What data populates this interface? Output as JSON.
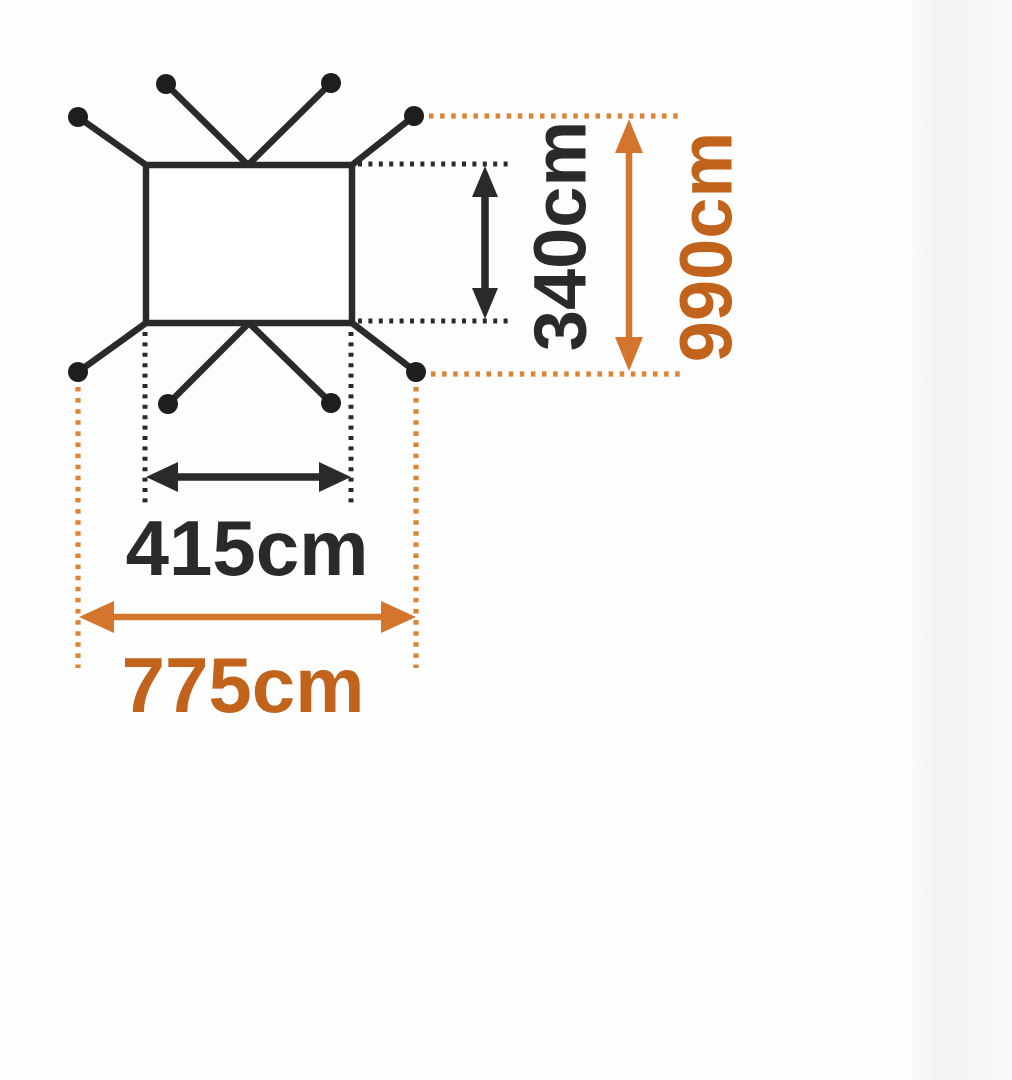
{
  "page": {
    "background_color": "#fdfdfd",
    "right_strip_color": "#f5f5f6"
  },
  "diagram": {
    "colors": {
      "page-bg": "#fdfdfd",
      "ink": "#2a2a2a",
      "stake": "#1e1e1e",
      "accent-text": "#c2631c",
      "accent-line": "#dd8334",
      "accent-arrow": "#d3752c"
    },
    "labels": {
      "inner_width": "415cm",
      "inner_depth": "340cm",
      "outer_width": "775cm",
      "outer_depth": "990cm"
    }
  }
}
